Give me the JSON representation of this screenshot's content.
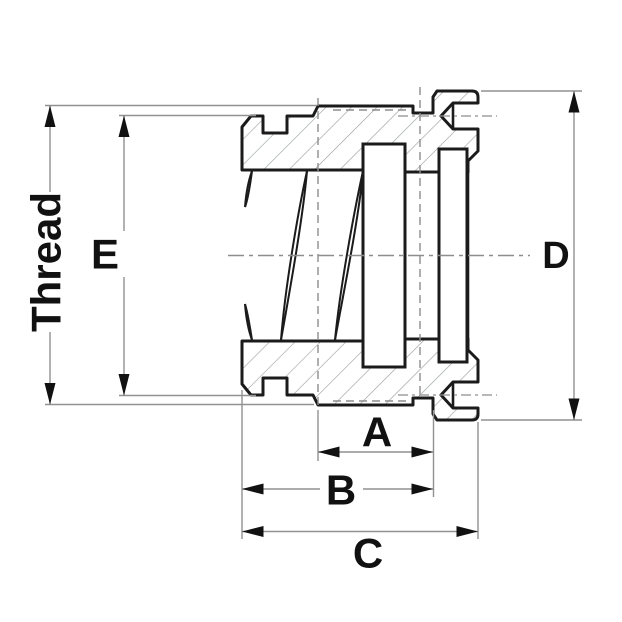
{
  "drawing": {
    "type": "technical-cross-section",
    "subject": "threaded hose coupling nut, sectional view",
    "labels": {
      "thread": "Thread",
      "e": "E",
      "d": "D",
      "a": "A",
      "b": "B",
      "c": "C"
    },
    "colors": {
      "outline": "#1b1b1b",
      "dimension_line": "#919191",
      "hatch": "#9ba0a0",
      "label": "#111111",
      "background": "#ffffff"
    }
  }
}
